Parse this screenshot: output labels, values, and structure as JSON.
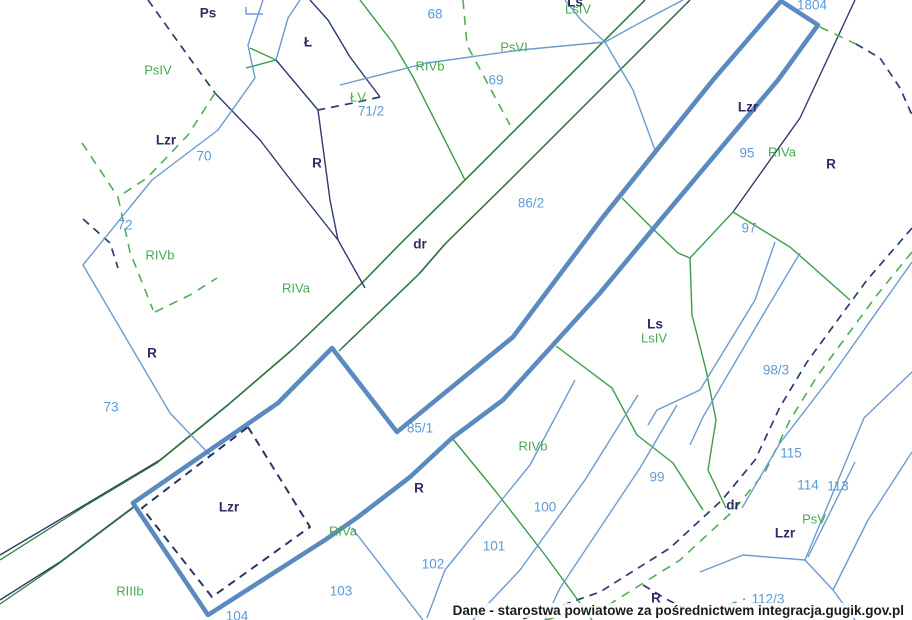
{
  "attribution": "Dane - starostwa powiatowe za pośrednictwem integracja.gugik.gov.pl",
  "colors": {
    "highlight": "#4d80bc",
    "parcel_number_text": "#5b9bd5",
    "land_use_text": "#46ab4e",
    "boundary_text": "#2d2d62",
    "navy_line": "#2e3b71",
    "green_line": "#3a9e47",
    "thin_blue_line": "#6b9bd2",
    "background": "#ffffff"
  },
  "parcel_numbers": [
    {
      "text": "68",
      "x": 435,
      "y": 14
    },
    {
      "text": "69",
      "x": 496,
      "y": 80
    },
    {
      "text": "70",
      "x": 204,
      "y": 156
    },
    {
      "text": "71/2",
      "x": 371,
      "y": 111
    },
    {
      "text": "72",
      "x": 125,
      "y": 225
    },
    {
      "text": "73",
      "x": 111,
      "y": 407
    },
    {
      "text": "85/1",
      "x": 420,
      "y": 428
    },
    {
      "text": "86/2",
      "x": 531,
      "y": 203
    },
    {
      "text": "95",
      "x": 747,
      "y": 153
    },
    {
      "text": "97",
      "x": 749,
      "y": 228
    },
    {
      "text": "98/3",
      "x": 776,
      "y": 370
    },
    {
      "text": "99",
      "x": 657,
      "y": 477
    },
    {
      "text": "100",
      "x": 545,
      "y": 507
    },
    {
      "text": "101",
      "x": 494,
      "y": 546
    },
    {
      "text": "102",
      "x": 433,
      "y": 564
    },
    {
      "text": "103",
      "x": 341,
      "y": 591
    },
    {
      "text": "104",
      "x": 237,
      "y": 616
    },
    {
      "text": "112/3",
      "x": 768,
      "y": 599
    },
    {
      "text": "113",
      "x": 838,
      "y": 486
    },
    {
      "text": "114",
      "x": 808,
      "y": 485
    },
    {
      "text": "115",
      "x": 791,
      "y": 453
    },
    {
      "text": "1804",
      "x": 812,
      "y": 5
    }
  ],
  "land_use_labels": [
    {
      "text": "PsIV",
      "x": 158,
      "y": 70
    },
    {
      "text": "PsVI",
      "x": 514,
      "y": 47
    },
    {
      "text": "RIVb",
      "x": 430,
      "y": 66
    },
    {
      "text": "ŁV",
      "x": 358,
      "y": 97
    },
    {
      "text": "LsIV",
      "x": 578,
      "y": 9
    },
    {
      "text": "RIVb",
      "x": 160,
      "y": 255
    },
    {
      "text": "RIVa",
      "x": 296,
      "y": 288
    },
    {
      "text": "RIVa",
      "x": 782,
      "y": 152
    },
    {
      "text": "LsIV",
      "x": 654,
      "y": 338
    },
    {
      "text": "RIVb",
      "x": 533,
      "y": 446
    },
    {
      "text": "RIVa",
      "x": 343,
      "y": 531
    },
    {
      "text": "RIIIb",
      "x": 130,
      "y": 591
    },
    {
      "text": "PsV",
      "x": 814,
      "y": 519
    }
  ],
  "boundary_labels": [
    {
      "text": "Ps",
      "x": 208,
      "y": 13
    },
    {
      "text": "Ł",
      "x": 308,
      "y": 42
    },
    {
      "text": "Lzr",
      "x": 166,
      "y": 140
    },
    {
      "text": "R",
      "x": 317,
      "y": 163
    },
    {
      "text": "R",
      "x": 831,
      "y": 164
    },
    {
      "text": "Lzr",
      "x": 748,
      "y": 107
    },
    {
      "text": "Ls",
      "x": 575,
      "y": 2
    },
    {
      "text": "dr",
      "x": 420,
      "y": 244
    },
    {
      "text": "R",
      "x": 152,
      "y": 353
    },
    {
      "text": "Ls",
      "x": 655,
      "y": 324
    },
    {
      "text": "Lzr",
      "x": 229,
      "y": 507
    },
    {
      "text": "R",
      "x": 419,
      "y": 488
    },
    {
      "text": "dr",
      "x": 733,
      "y": 505
    },
    {
      "text": "Lzr",
      "x": 785,
      "y": 533
    },
    {
      "text": "R",
      "x": 656,
      "y": 598
    }
  ]
}
